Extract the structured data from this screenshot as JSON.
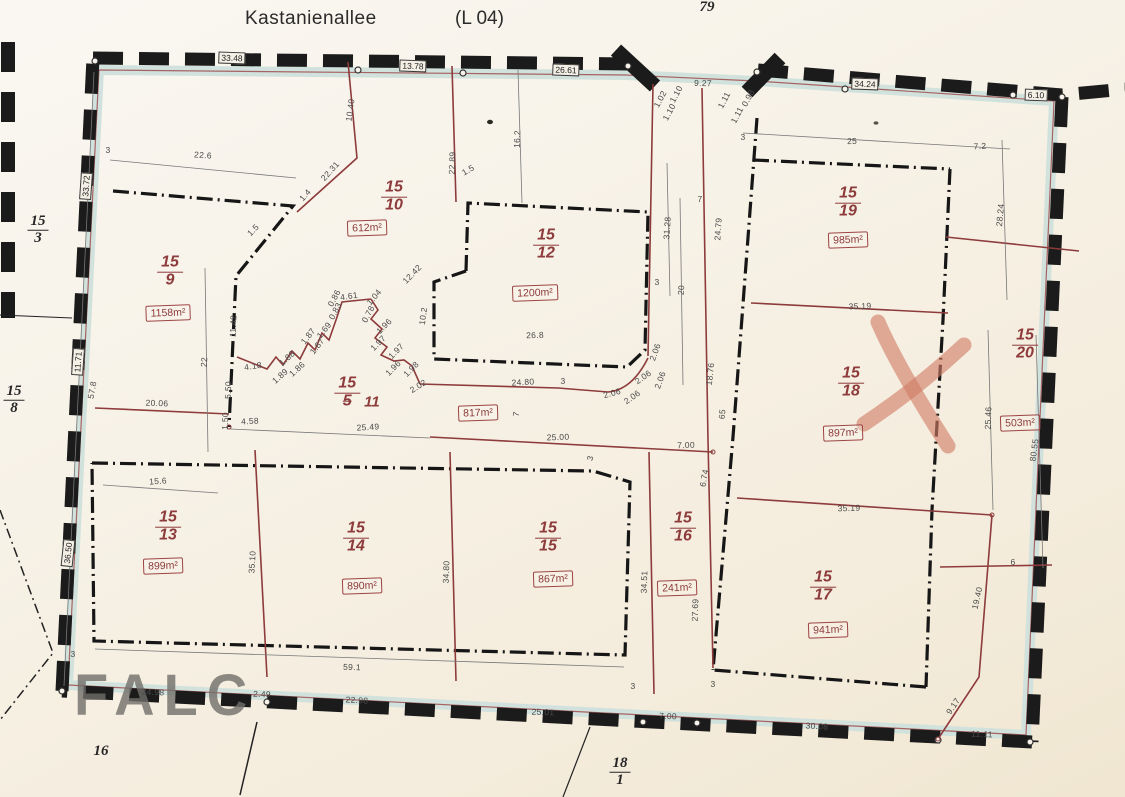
{
  "header": {
    "street": "Kastanienallee",
    "road_ref": "(L 04)"
  },
  "watermark": "FALC",
  "colors": {
    "paper": "#f7f2e8",
    "border_ink": "#1b1b1b",
    "boundary_red": "#8d3b3b",
    "band_cyan": "#cfe0dc",
    "dim_text": "#4a4a4a",
    "x_mark": "#d08a76"
  },
  "parcels": [
    {
      "label": "15",
      "sub": "9",
      "area": "1158m²",
      "lx": 170,
      "ly": 272,
      "ax": 168,
      "ay": 313
    },
    {
      "label": "15",
      "sub": "10",
      "area": "612m²",
      "lx": 394,
      "ly": 197,
      "ax": 367,
      "ay": 228
    },
    {
      "label": "15",
      "sub": "12",
      "area": "1200m²",
      "lx": 546,
      "ly": 245,
      "ax": 535,
      "ay": 293
    },
    {
      "label": "15",
      "sub": "5",
      "sub_struck": true,
      "suffix": "11",
      "area": "817m²",
      "lx": 357,
      "ly": 393,
      "ax": 478,
      "ay": 413
    },
    {
      "label": "15",
      "sub": "19",
      "area": "985m²",
      "lx": 848,
      "ly": 203,
      "ax": 848,
      "ay": 240
    },
    {
      "label": "15",
      "sub": "18",
      "area": "897m²",
      "lx": 851,
      "ly": 383,
      "ax": 843,
      "ay": 433
    },
    {
      "label": "15",
      "sub": "20",
      "area": "503m²",
      "lx": 1025,
      "ly": 345,
      "ax": 1020,
      "ay": 423
    },
    {
      "label": "15",
      "sub": "13",
      "area": "899m²",
      "lx": 168,
      "ly": 527,
      "ax": 163,
      "ay": 566
    },
    {
      "label": "15",
      "sub": "14",
      "area": "890m²",
      "lx": 356,
      "ly": 538,
      "ax": 362,
      "ay": 586
    },
    {
      "label": "15",
      "sub": "15",
      "area": "867m²",
      "lx": 548,
      "ly": 538,
      "ax": 553,
      "ay": 579
    },
    {
      "label": "15",
      "sub": "16",
      "area": "241m²",
      "lx": 683,
      "ly": 528,
      "ax": 677,
      "ay": 588
    },
    {
      "label": "15",
      "sub": "17",
      "area": "941m²",
      "lx": 823,
      "ly": 587,
      "ax": 828,
      "ay": 630
    }
  ],
  "neighbor_labels": [
    {
      "label": "15",
      "sub": "3",
      "x": 38,
      "y": 230
    },
    {
      "label": "15",
      "sub": "8",
      "x": 14,
      "y": 400
    },
    {
      "label": "18",
      "sub": "1",
      "x": 620,
      "y": 772
    },
    {
      "text": "16",
      "x": 101,
      "y": 752
    },
    {
      "text": "79",
      "x": 707,
      "y": 8
    }
  ],
  "border_measurements": [
    {
      "t": "33.48",
      "x": 232,
      "y": 58,
      "r": 2
    },
    {
      "t": "13.78",
      "x": 413,
      "y": 66,
      "r": 2
    },
    {
      "t": "26.61",
      "x": 566,
      "y": 70,
      "r": 2
    },
    {
      "t": "34.24",
      "x": 865,
      "y": 84,
      "r": 2
    },
    {
      "t": "6.10",
      "x": 1036,
      "y": 95,
      "r": 2
    },
    {
      "t": "33.72",
      "x": 86,
      "y": 186,
      "r": -86
    },
    {
      "t": "11.71",
      "x": 78,
      "y": 362,
      "r": -86
    },
    {
      "t": "36.50",
      "x": 68,
      "y": 553,
      "r": -84
    }
  ],
  "dimensions": [
    {
      "t": "9.27",
      "x": 703,
      "y": 83,
      "r": 2
    },
    {
      "t": "1.02",
      "x": 660,
      "y": 99,
      "r": -62
    },
    {
      "t": "1.10",
      "x": 676,
      "y": 94,
      "r": -62
    },
    {
      "t": "1.10",
      "x": 669,
      "y": 112,
      "r": -62
    },
    {
      "t": "1.11",
      "x": 724,
      "y": 100,
      "r": -62
    },
    {
      "t": "1.11",
      "x": 737,
      "y": 115,
      "r": -62
    },
    {
      "t": "0.98",
      "x": 748,
      "y": 98,
      "r": -62
    },
    {
      "t": "3",
      "x": 108,
      "y": 150,
      "r": 0
    },
    {
      "t": "22.6",
      "x": 203,
      "y": 155,
      "r": 4
    },
    {
      "t": "10.40",
      "x": 350,
      "y": 110,
      "r": -82
    },
    {
      "t": "22.31",
      "x": 330,
      "y": 171,
      "r": -48
    },
    {
      "t": "1.4",
      "x": 305,
      "y": 195,
      "r": -48
    },
    {
      "t": "1.5",
      "x": 253,
      "y": 230,
      "r": -45
    },
    {
      "t": "22.89",
      "x": 452,
      "y": 163,
      "r": -88
    },
    {
      "t": "1.5",
      "x": 468,
      "y": 170,
      "r": -30
    },
    {
      "t": "16.2",
      "x": 517,
      "y": 139,
      "r": -88
    },
    {
      "t": "12.42",
      "x": 412,
      "y": 274,
      "r": -46
    },
    {
      "t": "11.42",
      "x": 233,
      "y": 326,
      "r": -88
    },
    {
      "t": "22",
      "x": 204,
      "y": 362,
      "r": -86
    },
    {
      "t": "5.50",
      "x": 228,
      "y": 390,
      "r": -88
    },
    {
      "t": "1.50",
      "x": 225,
      "y": 421,
      "r": -88
    },
    {
      "t": "20.06",
      "x": 157,
      "y": 403,
      "r": 2
    },
    {
      "t": "4.58",
      "x": 250,
      "y": 421,
      "r": -3
    },
    {
      "t": "4.18",
      "x": 253,
      "y": 366,
      "r": -8
    },
    {
      "t": "1.89",
      "x": 280,
      "y": 376,
      "r": -42
    },
    {
      "t": "1.88",
      "x": 287,
      "y": 358,
      "r": -42
    },
    {
      "t": "1.86",
      "x": 297,
      "y": 369,
      "r": -42
    },
    {
      "t": "1.87",
      "x": 308,
      "y": 336,
      "r": -52
    },
    {
      "t": "1.87",
      "x": 317,
      "y": 346,
      "r": -52
    },
    {
      "t": "1.69",
      "x": 324,
      "y": 330,
      "r": -52
    },
    {
      "t": "0.86",
      "x": 334,
      "y": 298,
      "r": -62
    },
    {
      "t": "0.83",
      "x": 335,
      "y": 311,
      "r": -62
    },
    {
      "t": "4.61",
      "x": 349,
      "y": 296,
      "r": -8
    },
    {
      "t": "1.04",
      "x": 374,
      "y": 297,
      "r": -50
    },
    {
      "t": "0.78",
      "x": 368,
      "y": 314,
      "r": -62
    },
    {
      "t": "1.96",
      "x": 384,
      "y": 326,
      "r": -45
    },
    {
      "t": "1.97",
      "x": 378,
      "y": 343,
      "r": -45
    },
    {
      "t": "1.97",
      "x": 396,
      "y": 351,
      "r": -45
    },
    {
      "t": "1.96",
      "x": 393,
      "y": 368,
      "r": -45
    },
    {
      "t": "1.98",
      "x": 411,
      "y": 369,
      "r": -45
    },
    {
      "t": "2.02",
      "x": 418,
      "y": 386,
      "r": -32
    },
    {
      "t": "10.2",
      "x": 423,
      "y": 316,
      "r": -82
    },
    {
      "t": "26.8",
      "x": 535,
      "y": 335,
      "r": -2
    },
    {
      "t": "24.80",
      "x": 523,
      "y": 382,
      "r": -3
    },
    {
      "t": "3",
      "x": 563,
      "y": 381,
      "r": 0
    },
    {
      "t": "25.49",
      "x": 368,
      "y": 427,
      "r": -3
    },
    {
      "t": "7",
      "x": 516,
      "y": 414,
      "r": -82
    },
    {
      "t": "25.00",
      "x": 558,
      "y": 437,
      "r": -2
    },
    {
      "t": "7.00",
      "x": 686,
      "y": 445,
      "r": -2
    },
    {
      "t": "3",
      "x": 590,
      "y": 458,
      "r": -75
    },
    {
      "t": "7",
      "x": 700,
      "y": 199,
      "r": 0
    },
    {
      "t": "31.28",
      "x": 667,
      "y": 228,
      "r": -86
    },
    {
      "t": "24.79",
      "x": 718,
      "y": 229,
      "r": -86
    },
    {
      "t": "20",
      "x": 681,
      "y": 290,
      "r": -86
    },
    {
      "t": "3",
      "x": 657,
      "y": 282,
      "r": 0
    },
    {
      "t": "2.06",
      "x": 655,
      "y": 352,
      "r": -70
    },
    {
      "t": "2.06",
      "x": 643,
      "y": 377,
      "r": -35
    },
    {
      "t": "2.06",
      "x": 660,
      "y": 380,
      "r": -70
    },
    {
      "t": "2.06",
      "x": 612,
      "y": 393,
      "r": -15
    },
    {
      "t": "2.06",
      "x": 632,
      "y": 397,
      "r": -35
    },
    {
      "t": "18.76",
      "x": 710,
      "y": 374,
      "r": -84
    },
    {
      "t": "65",
      "x": 722,
      "y": 414,
      "r": -84
    },
    {
      "t": "6.74",
      "x": 704,
      "y": 478,
      "r": -80
    },
    {
      "t": "34.51",
      "x": 644,
      "y": 582,
      "r": -88
    },
    {
      "t": "27.69",
      "x": 695,
      "y": 610,
      "r": -88
    },
    {
      "t": "3",
      "x": 743,
      "y": 137,
      "r": 0
    },
    {
      "t": "25",
      "x": 852,
      "y": 141,
      "r": -2
    },
    {
      "t": "7.2",
      "x": 980,
      "y": 146,
      "r": -3
    },
    {
      "t": "28.24",
      "x": 1000,
      "y": 215,
      "r": -85
    },
    {
      "t": "35.19",
      "x": 860,
      "y": 306,
      "r": -2
    },
    {
      "t": "25.46",
      "x": 988,
      "y": 418,
      "r": -88
    },
    {
      "t": "80.55",
      "x": 1034,
      "y": 450,
      "r": -82
    },
    {
      "t": "35.19",
      "x": 849,
      "y": 508,
      "r": -2
    },
    {
      "t": "6",
      "x": 1013,
      "y": 562,
      "r": 0
    },
    {
      "t": "19.40",
      "x": 977,
      "y": 598,
      "r": -77
    },
    {
      "t": "9.17",
      "x": 953,
      "y": 706,
      "r": -56
    },
    {
      "t": "15.6",
      "x": 158,
      "y": 481,
      "r": -4
    },
    {
      "t": "35.10",
      "x": 252,
      "y": 562,
      "r": -87
    },
    {
      "t": "34.80",
      "x": 446,
      "y": 572,
      "r": -88
    },
    {
      "t": "59.1",
      "x": 352,
      "y": 667,
      "r": 2
    },
    {
      "t": "57.8",
      "x": 92,
      "y": 390,
      "r": -80
    },
    {
      "t": "3",
      "x": 73,
      "y": 654,
      "r": 0
    },
    {
      "t": "24.98",
      "x": 153,
      "y": 692,
      "r": 2
    },
    {
      "t": "2.49",
      "x": 262,
      "y": 694,
      "r": 2
    },
    {
      "t": "22.98",
      "x": 357,
      "y": 700,
      "r": 3
    },
    {
      "t": "25.01",
      "x": 543,
      "y": 712,
      "r": 2
    },
    {
      "t": "3",
      "x": 633,
      "y": 686,
      "r": 0
    },
    {
      "t": "7.00",
      "x": 668,
      "y": 716,
      "r": 2
    },
    {
      "t": "3",
      "x": 713,
      "y": 684,
      "r": 0
    },
    {
      "t": "30.08",
      "x": 817,
      "y": 726,
      "r": 3
    },
    {
      "t": "11.11",
      "x": 982,
      "y": 734,
      "r": 2
    }
  ]
}
